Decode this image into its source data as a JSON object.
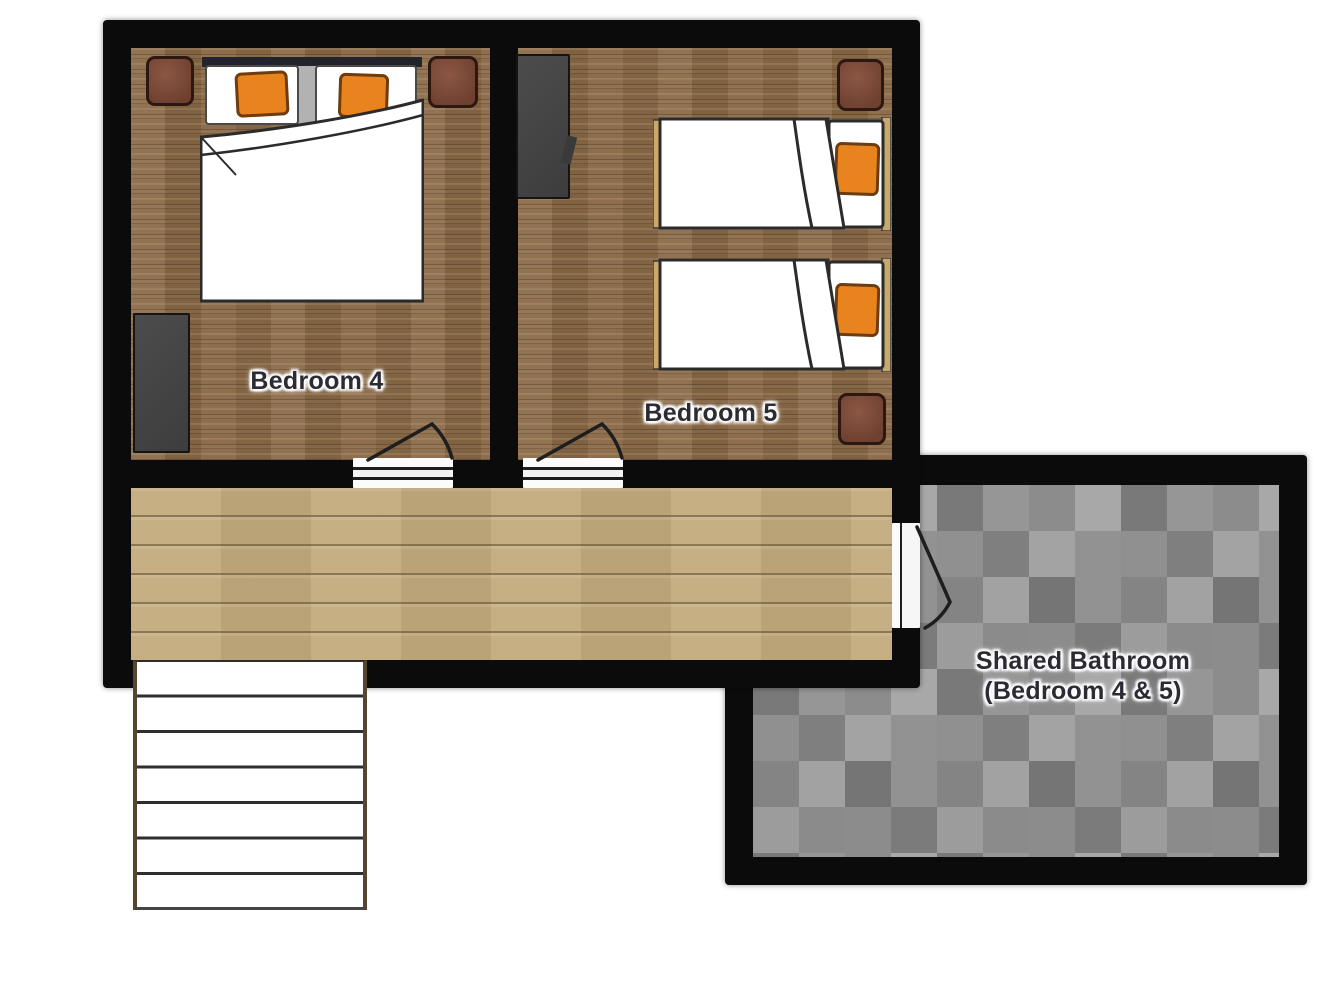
{
  "plan": {
    "type": "residential-floor-plan",
    "labels": {
      "bedroom4": "Bedroom 4",
      "bedroom5": "Bedroom 5",
      "bathroom_line1": "Shared Bathroom",
      "bathroom_line2": "(Bedroom 4 & 5)"
    },
    "rooms": [
      {
        "id": "bedroom4",
        "label": "Bedroom 4",
        "floor": "dark wood planks"
      },
      {
        "id": "bedroom5",
        "label": "Bedroom 5",
        "floor": "dark wood planks"
      },
      {
        "id": "hallway",
        "label": "",
        "floor": "light wood planks"
      },
      {
        "id": "shared-bathroom",
        "label": "Shared Bathroom (Bedroom 4 & 5)",
        "floor": "gray checker tile"
      }
    ],
    "furniture": [
      {
        "room": "bedroom4",
        "item": "double-bed",
        "pillows": 2,
        "pillow_color": "#e8831d"
      },
      {
        "room": "bedroom4",
        "item": "nightstand",
        "count": 2
      },
      {
        "room": "bedroom4",
        "item": "wardrobe",
        "count": 1
      },
      {
        "room": "bedroom5",
        "item": "single-bed",
        "count": 2,
        "pillow_color": "#e8831d"
      },
      {
        "room": "bedroom5",
        "item": "nightstand",
        "count": 2
      },
      {
        "room": "bedroom5",
        "item": "wardrobe",
        "count": 1
      },
      {
        "room": "hallway",
        "item": "staircase",
        "treads": 7
      },
      {
        "room": "doors",
        "item": "swing-door",
        "count": 3
      }
    ],
    "colors": {
      "wall": "#0b0b0b",
      "bedroom_floor": "#8a6946",
      "hallway_floor": "#c2ab7c",
      "bathroom_tile": "#8f8f8f",
      "accent_pillow": "#e8831d",
      "nightstand": "#7b4836",
      "wardrobe": "#454545",
      "bed_frame_tan": "#c9a96b",
      "label_text": "#2b2b33"
    }
  }
}
